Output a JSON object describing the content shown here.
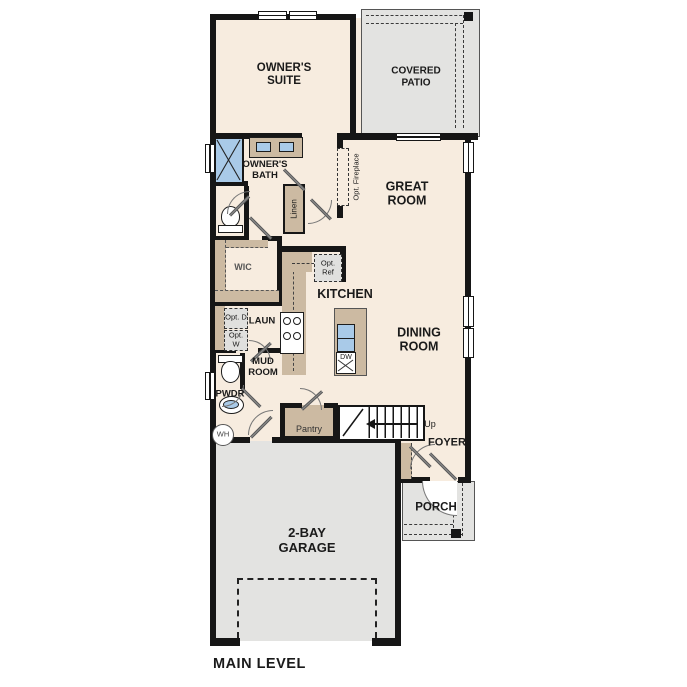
{
  "title": "MAIN LEVEL",
  "colors": {
    "floor": "#f7ecdf",
    "outdoor": "#e3e3e1",
    "casework": "#ccbaa2",
    "fixture_blue": "#a9cae8",
    "opt_box": "#e0e0de",
    "wall": "#161616",
    "text": "#1a1a1a"
  },
  "rooms": {
    "owners_suite": "OWNER'S SUITE",
    "covered_patio": "COVERED PATIO",
    "owners_bath": "OWNER'S BATH",
    "great_room": "GREAT ROOM",
    "wic": "WIC",
    "kitchen": "KITCHEN",
    "dining_room": "DINING ROOM",
    "laundry": "LAUN",
    "mud_room": "MUD ROOM",
    "powder": "PWDR",
    "pantry": "Pantry",
    "foyer": "FOYER",
    "porch": "PORCH",
    "garage": "2-BAY GARAGE"
  },
  "fixtures": {
    "opt_fireplace": "Opt. Fireplace",
    "opt_ref": "Opt. Ref",
    "opt_dryer": "Opt. D",
    "opt_washer": "Opt. W",
    "linen": "Linen",
    "dishwasher": "DW",
    "water_heater": "WH",
    "stairs_up": "Up"
  },
  "footer": {
    "label": "MAIN LEVEL"
  }
}
